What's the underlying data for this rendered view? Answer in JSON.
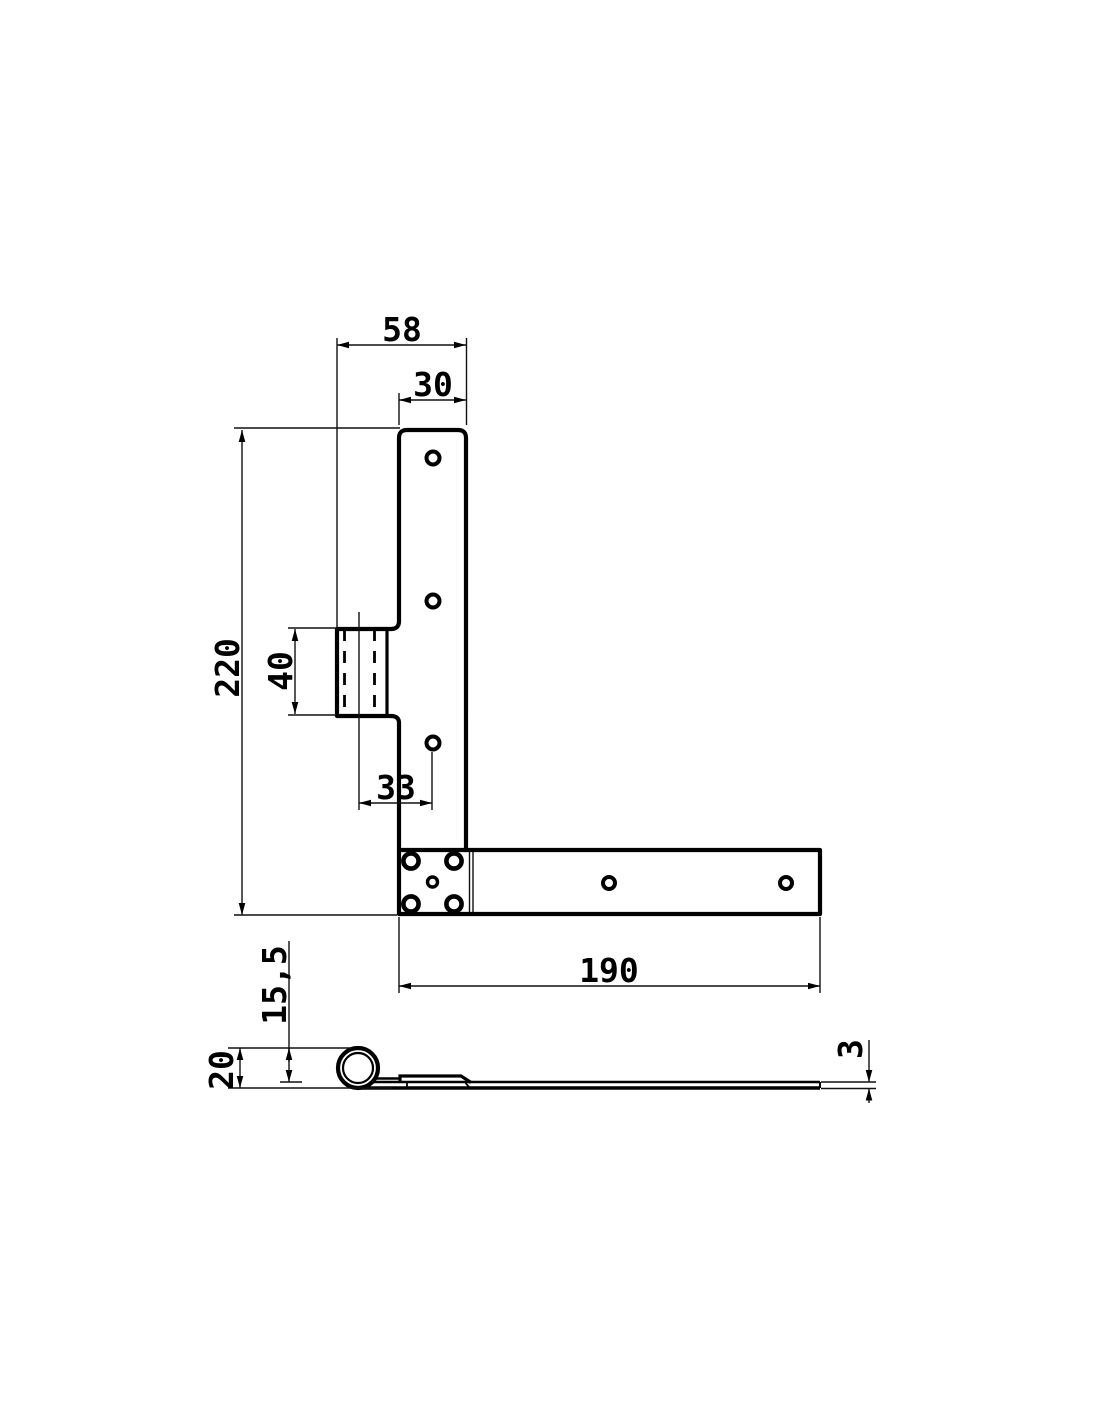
{
  "drawing": {
    "background": "#ffffff",
    "line_color": "#000000",
    "views": {
      "front": {
        "dims": {
          "flange_span": "58",
          "plate_width": "30",
          "overall_height": "220",
          "knuckle_length": "40",
          "pin_to_hole": "33",
          "strap_length": "190"
        },
        "hole_counts": {
          "vertical_plate": 3,
          "corner_plate": 5,
          "strap": 2
        }
      },
      "side": {
        "dims": {
          "roll_offset": "15,5",
          "roll_height": "20",
          "material_thickness": "3"
        }
      }
    }
  }
}
